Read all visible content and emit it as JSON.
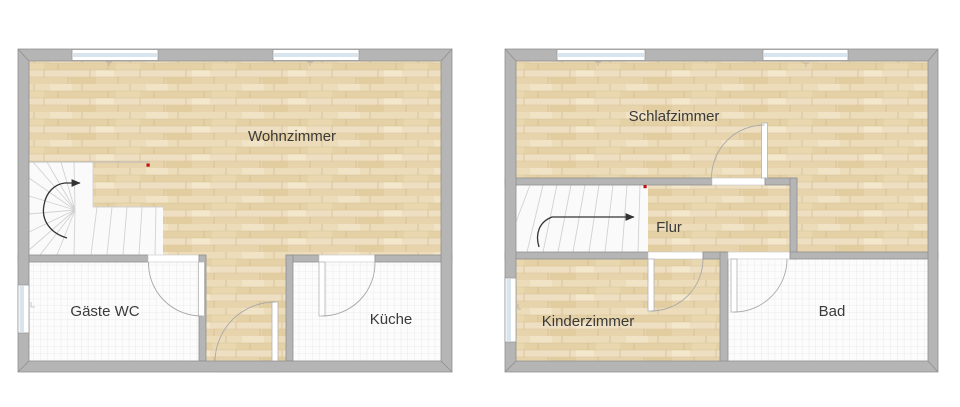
{
  "ground_floor": {
    "rooms": {
      "wohnzimmer": {
        "label": "Wohnzimmer"
      },
      "gaeste_wc": {
        "label": "Gäste WC"
      },
      "kueche": {
        "label": "Küche"
      }
    },
    "features": {
      "staircase": "winder-staircase-with-direction-arrow",
      "marker": "red-marker-dot",
      "window_count": 3,
      "entry": "entry-door-bottom-center"
    }
  },
  "upper_floor": {
    "rooms": {
      "schlafzimmer": {
        "label": "Schlafzimmer"
      },
      "flur": {
        "label": "Flur"
      },
      "kinderzimmer": {
        "label": "Kinderzimmer"
      },
      "bad": {
        "label": "Bad"
      }
    },
    "features": {
      "staircase": "straight-winder-staircase-with-direction-arrow",
      "marker": "red-marker-dot",
      "window_count": 3
    }
  },
  "colors": {
    "wall_fill": "#b5b5b5",
    "wall_outline": "#8f8f8f",
    "wood_floor": "#e9d6b0",
    "tile_floor": "#fcfcfc",
    "tile_grid": "#dedede",
    "stair_fill": "#fafafa",
    "window_glass": "#d9e5ee",
    "marker_red": "#c40f0f",
    "label_text": "#3a3a3a",
    "background": "#ffffff"
  }
}
